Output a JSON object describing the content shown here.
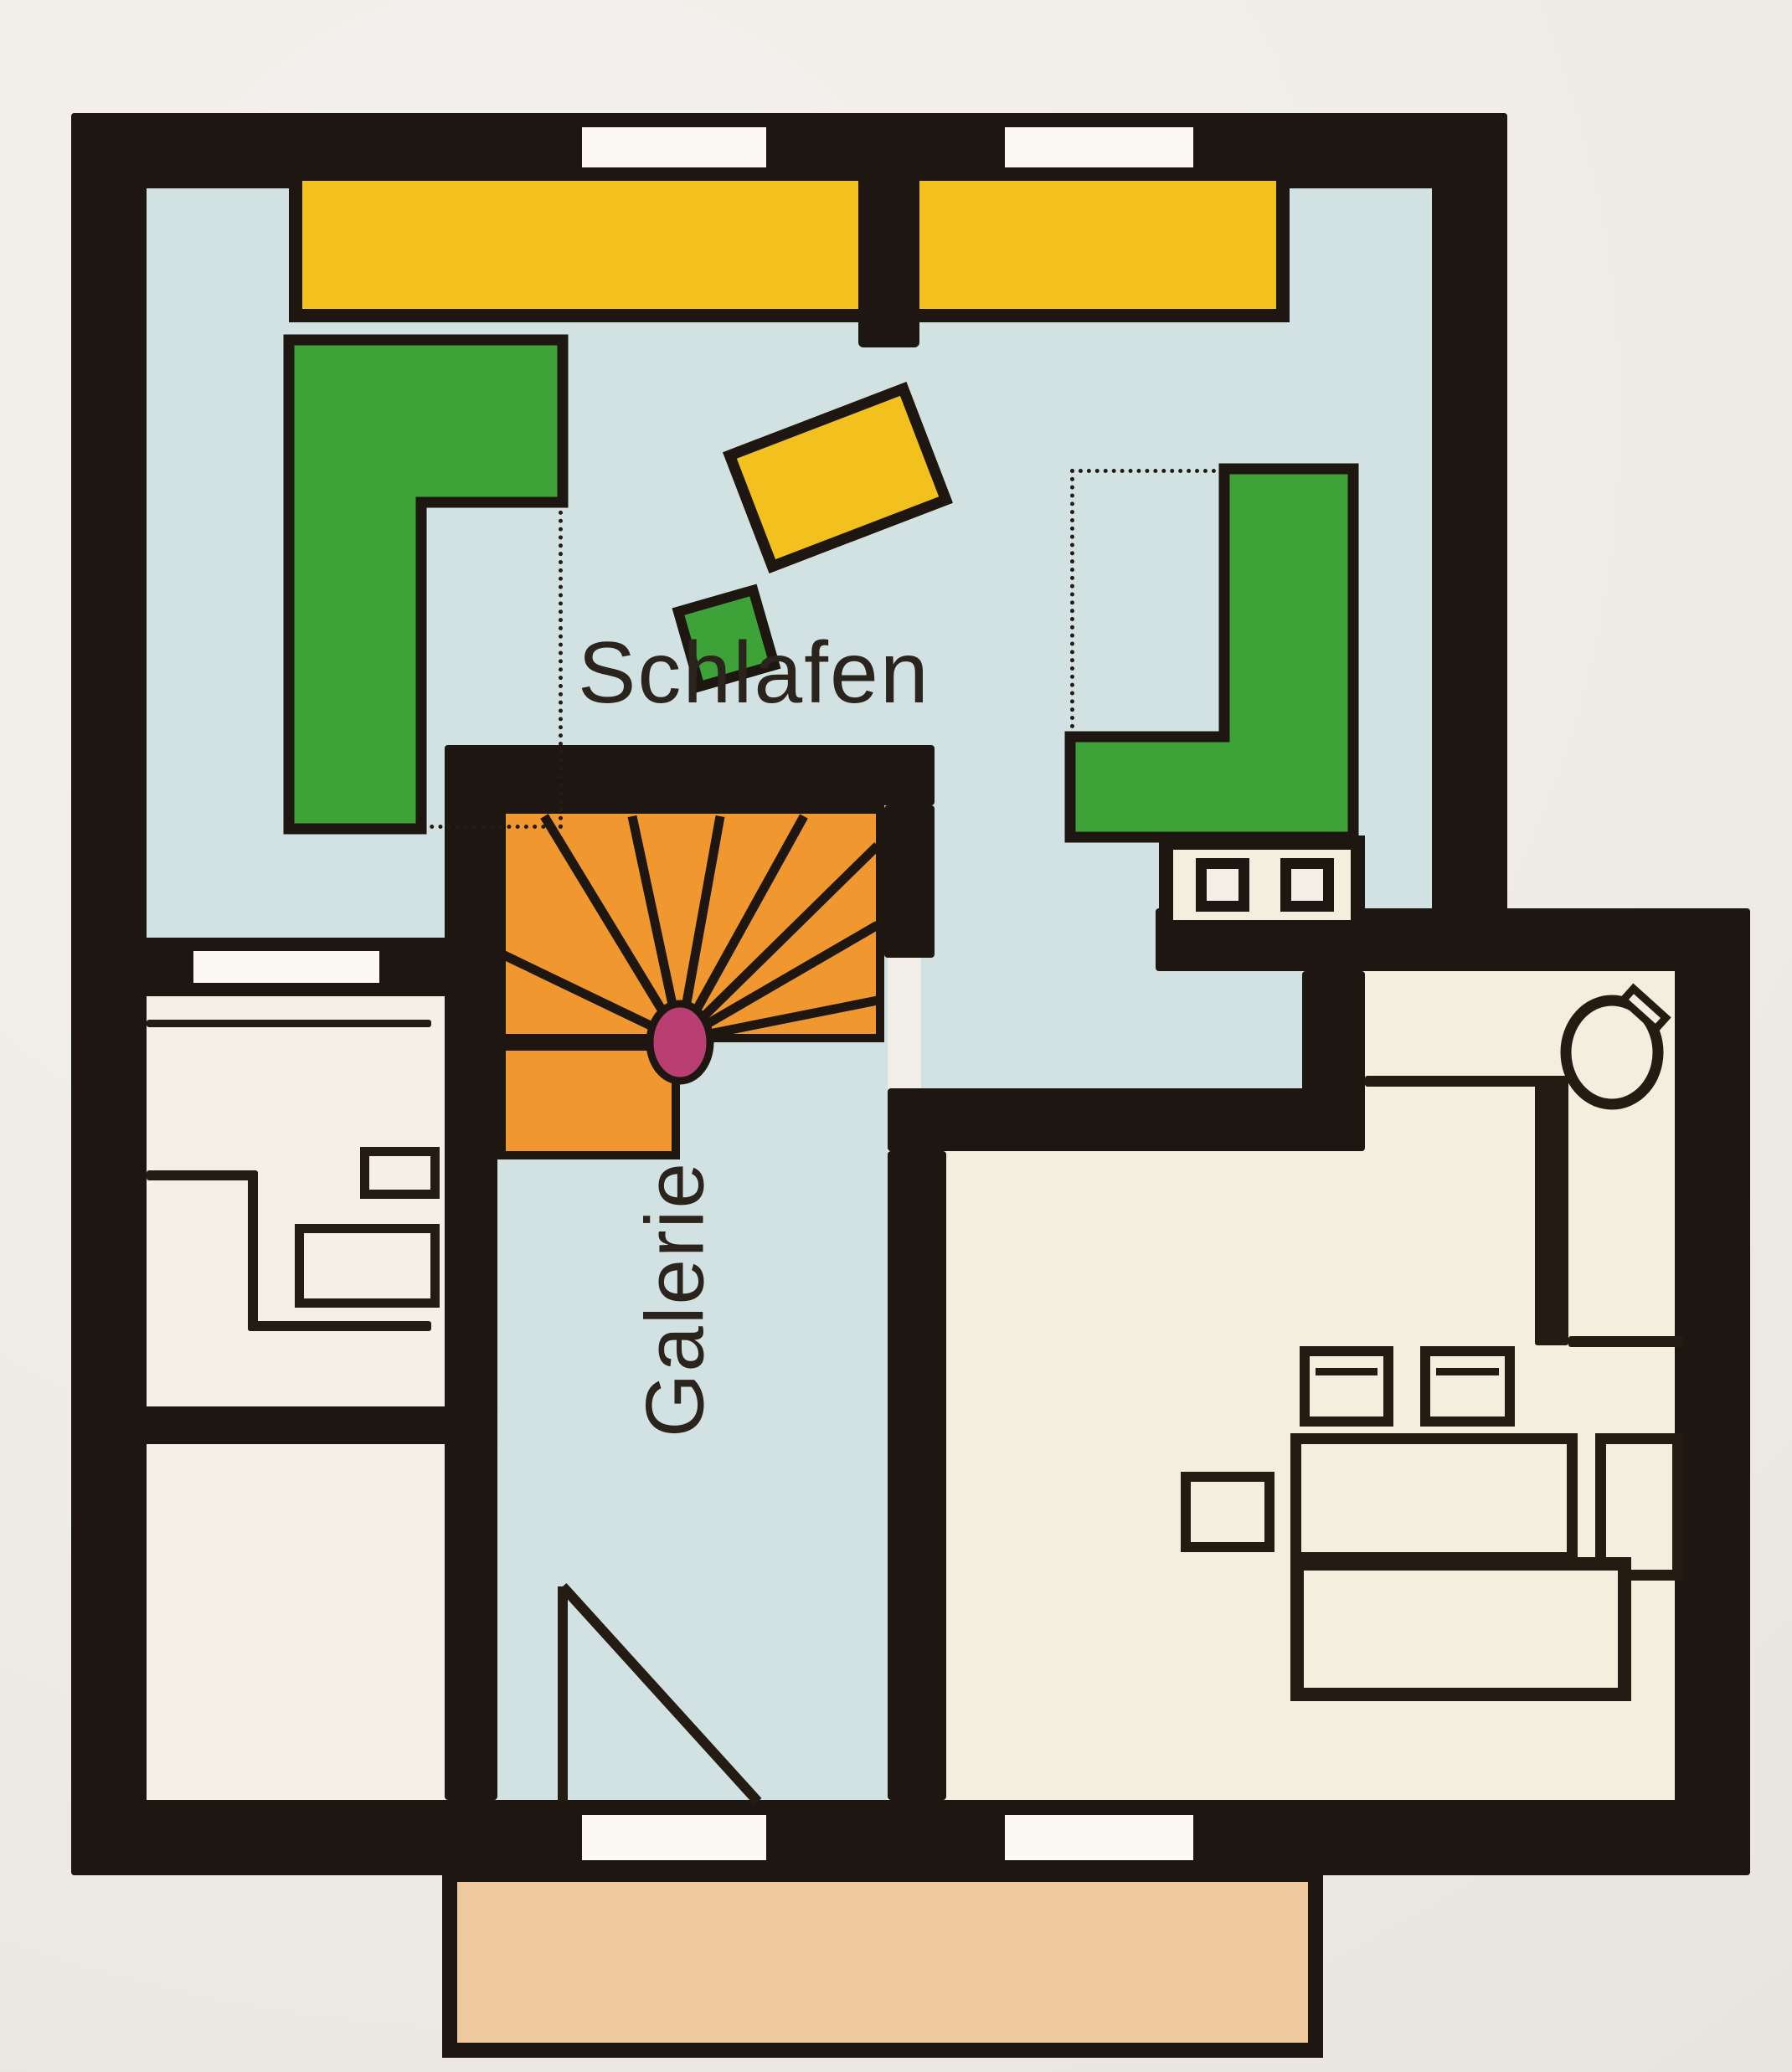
{
  "document": {
    "type": "scanned color floor plan (photograph of printed page)",
    "floor_shown": "upper floor with bedroom and gallery"
  },
  "labels": {
    "bedroom": "Schlafen",
    "gallery": "Galerie"
  },
  "palette": {
    "paper": "#f0ede8",
    "wall": "#1e1610",
    "floor_blue": "#d2e2e3",
    "floor_cream": "#f3eedd",
    "floor_white": "#f4f0e7",
    "opening_white": "#fbf9f1",
    "furniture_yellow": "#f2c11d",
    "furniture_green": "#3da339",
    "stair_orange": "#f09730",
    "newel_magenta": "#b93f72",
    "balcony_tan": "#eec99d",
    "line_dark": "#241b12",
    "text": "#2b241c"
  },
  "rooms": [
    {
      "name": "Schlafen",
      "floor_color": "#d2e2e3",
      "label_visible": true
    },
    {
      "name": "Galerie",
      "floor_color": "#d2e2e3",
      "label_visible": true
    },
    {
      "name": "left upper side room",
      "floor_color": "#f4f0e7",
      "label_visible": false
    },
    {
      "name": "left lower side room",
      "floor_color": "#f4f0e7",
      "label_visible": false
    },
    {
      "name": "lower right room",
      "floor_color": "#f3eedd",
      "label_visible": false
    },
    {
      "name": "balcony",
      "floor_color": "#eec99d",
      "label_visible": false
    }
  ],
  "furniture": [
    "wardrobe-bar-yellow",
    "chimney-stub",
    "bed-left-green-L",
    "bed-right-green-L",
    "dashed-bed-outline-left",
    "dashed-bed-outline-right",
    "tilted-yellow-table",
    "tilted-green-stool",
    "washbasin-unit-two-sinks",
    "winder-staircase-orange",
    "newel-post",
    "void-triangle",
    "bathroom-fixtures",
    "round-fixture-with-tap",
    "dining-chair",
    "dining-chair",
    "dining-chair",
    "dining-table",
    "sideboard",
    "low-platform"
  ]
}
